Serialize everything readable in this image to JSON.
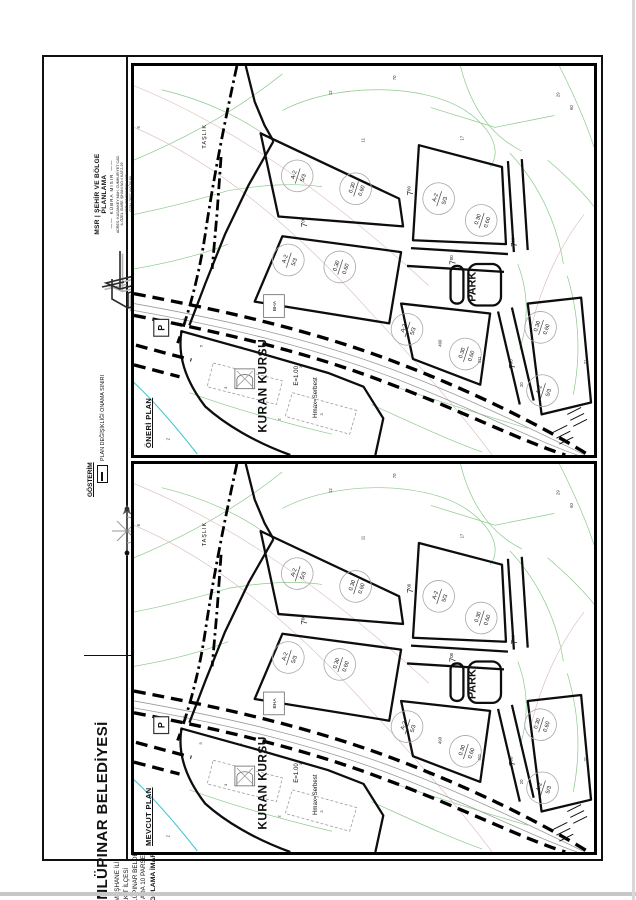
{
  "firm": {
    "name": "MSR | ŞEHİR VE BÖLGE PLANLAMA",
    "person": "KÜBRA MISIR",
    "address_lines": [
      "ADRES: KASANKEY MAH. CUMHURİYET CAD.",
      "İL ÖZEL İDARE İŞHANI NO:4 KAT:2-29",
      "MERKEZ/GÜMÜŞHANE"
    ],
    "gsm": "GSM: 0537 460 59 89",
    "email": "E-MAIL: kubra_msr@hotmail.com"
  },
  "legend": {
    "title": "GÖSTERİM",
    "item_label": "PLAN DEĞİŞİKLİĞİ ONAMA SINIRI"
  },
  "scale_label": "ÖLÇEK: 1/1000",
  "title_block": {
    "municipality": "ÜNLÜPINAR BELEDİYESİ",
    "province": "GÜMÜŞHANE İLİ",
    "district": "KELKİT İLÇESİ",
    "town": "ÜNLÜPINAR BELDESİ",
    "parcel": "654 ADA 10 PARSEL",
    "subject": "UYGULAMA İMAR PLANI DEĞİŞİKLİĞİ BİLGİ PAFTASI"
  },
  "panels": {
    "oneri": "ÖNERİ PLAN",
    "mevcut": "MEVCUT PLAN"
  },
  "map": {
    "labels": {
      "taslik": "TAŞLIK",
      "kuran_kursu": "KURAN KURSU",
      "emsal": "E=1.00",
      "hmax": "Hmax=Serbest",
      "bha": "BHA",
      "park": "PARK",
      "parking": "P"
    },
    "zoning": {
      "l1": "A-2",
      "l2": "5/3"
    },
    "ratio": {
      "l1": "0.30",
      "l2": "0.60"
    },
    "road_width": {
      "int": "7",
      "dec": "00"
    },
    "numbers": {
      "n6": "6",
      "n12": "12",
      "n70": "70",
      "n11": "11",
      "n17": "17",
      "n29": "29",
      "n60": "60",
      "n31": "31",
      "n13": "13",
      "n2": "2",
      "n490": "490",
      "n411": "411",
      "n20": "20"
    },
    "setbacks": {
      "s5": "5",
      "s3": "3",
      "s2": "2"
    }
  },
  "colors": {
    "cadastral_green": "#8cc98c",
    "contour_pink": "#ddc2c2",
    "stream_cyan": "#45c8d8",
    "ink": "#111111"
  }
}
